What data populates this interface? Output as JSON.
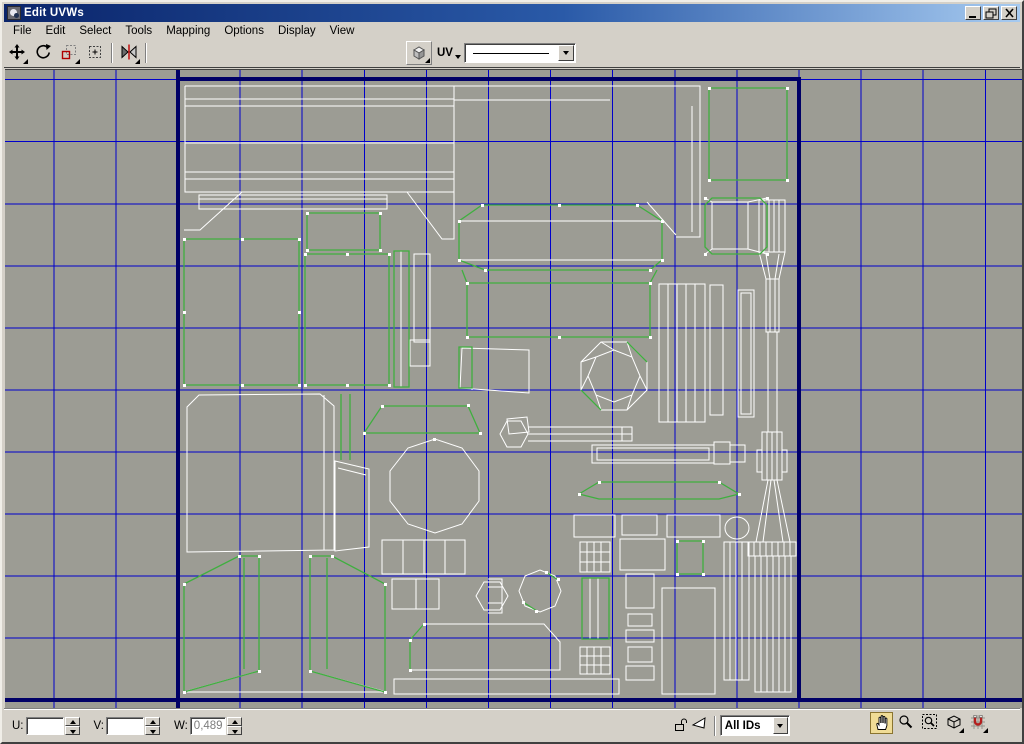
{
  "window": {
    "title": "Edit UVWs",
    "controls": [
      "minimize",
      "maximize",
      "close"
    ]
  },
  "menu": {
    "items": [
      "File",
      "Edit",
      "Select",
      "Tools",
      "Mapping",
      "Options",
      "Display",
      "View"
    ]
  },
  "toolbar": {
    "tools": [
      "move",
      "rotate",
      "scale",
      "freeform-gizmo",
      "mirror"
    ],
    "texture_button": "show-map",
    "uv_label": "UV",
    "texture_dropdown_selected": ""
  },
  "statusbar": {
    "u": {
      "label": "U:",
      "value": ""
    },
    "v": {
      "label": "V:",
      "value": ""
    },
    "w": {
      "label": "W:",
      "value": "0,489"
    },
    "lock_icon": "unlocked-padlock",
    "filter_icon": "filter-faces",
    "id_filter": {
      "value": "All IDs"
    },
    "nav_tools": [
      "pan",
      "zoom",
      "zoom-region",
      "zoom-extents",
      "snap-toggle"
    ],
    "active_tool": "pan"
  },
  "colors": {
    "titlebar_start": "#0a246a",
    "titlebar_end": "#a6caf0",
    "chrome": "#d4d0c8",
    "canvas_bg": "#9c9c94",
    "grid_blue": "#0000cc",
    "axis_navy": "#000066",
    "wire_white": "#ffffff",
    "wire_green": "#3faf3f",
    "active_tool_bg": "#f0dc96"
  }
}
